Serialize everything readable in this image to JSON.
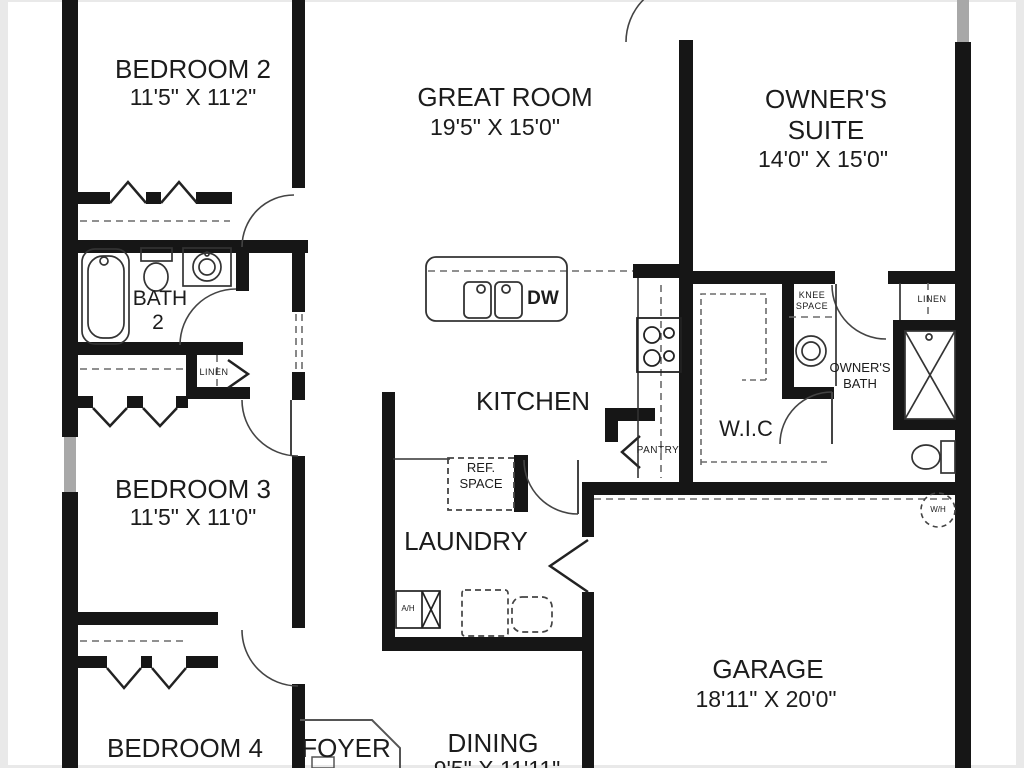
{
  "colors": {
    "walls": "#161616",
    "thin_lines": "#3a3a3a",
    "dashes": "#6b6b6b",
    "background": "#ffffff",
    "window": "#a8a8a8"
  },
  "rooms": {
    "bedroom2": {
      "name": "BEDROOM 2",
      "dims": "11'5\" X 11'2\""
    },
    "great_room": {
      "name": "GREAT ROOM",
      "dims": "19'5\" X 15'0\""
    },
    "owners_suite": {
      "line1": "OWNER'S",
      "line2": "SUITE",
      "dims": "14'0\" X 15'0\""
    },
    "bath2": {
      "line1": "BATH",
      "line2": "2"
    },
    "bedroom3": {
      "name": "BEDROOM 3",
      "dims": "11'5\" X 11'0\""
    },
    "kitchen": {
      "name": "KITCHEN"
    },
    "wic": {
      "name": "W.I.C"
    },
    "owners_bath": {
      "line1": "OWNER'S",
      "line2": "BATH"
    },
    "laundry": {
      "name": "LAUNDRY"
    },
    "garage": {
      "name": "GARAGE",
      "dims": "18'11\" X 20'0\""
    },
    "bedroom4": {
      "name": "BEDROOM 4"
    },
    "foyer": {
      "name": "FOYER"
    },
    "dining": {
      "name": "DINING",
      "dims": "9'5\" X 11'11\""
    }
  },
  "fixtures": {
    "dishwasher": "DW",
    "ref_space": {
      "line1": "REF.",
      "line2": "SPACE"
    },
    "hall_linen": "LINEN",
    "owners_linen": "LINEN",
    "knee_space": {
      "line1": "KNEE",
      "line2": "SPACE"
    },
    "pantry": "PANTRY",
    "air_handler": "A/H",
    "water_heater": "W/H"
  }
}
